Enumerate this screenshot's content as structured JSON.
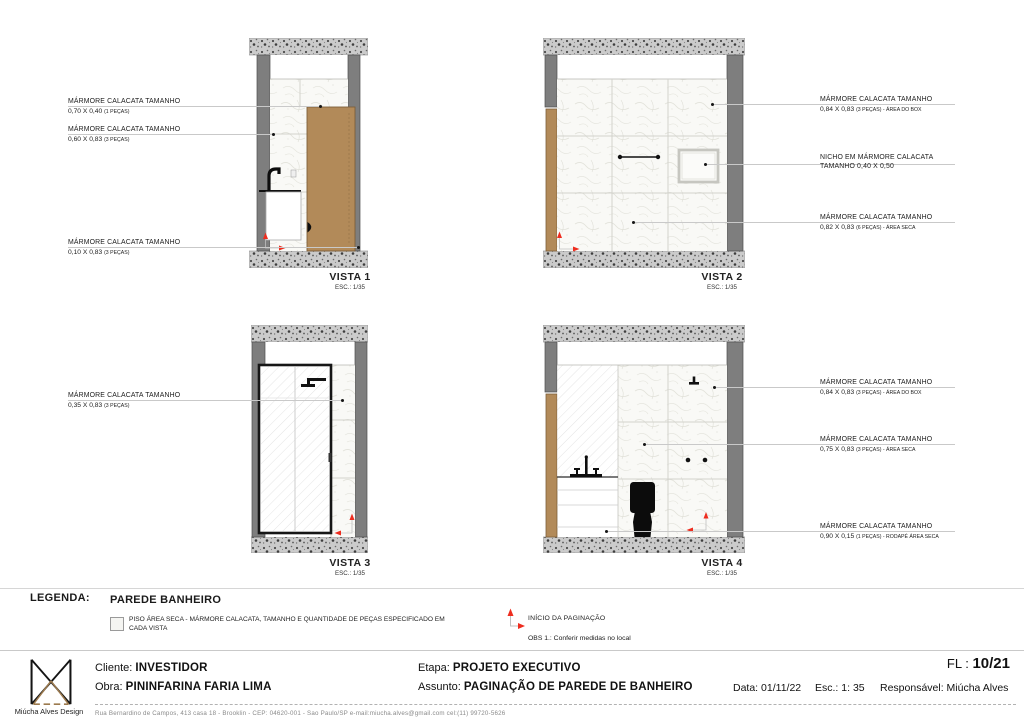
{
  "vistas": [
    {
      "label": "VISTA 1",
      "esc": "ESC.: 1/35"
    },
    {
      "label": "VISTA 2",
      "esc": "ESC.: 1/35"
    },
    {
      "label": "VISTA 3",
      "esc": "ESC.: 1/35"
    },
    {
      "label": "VISTA 4",
      "esc": "ESC.: 1/35"
    }
  ],
  "ann": {
    "v1": [
      {
        "title": "MÁRMORE CALACATA TAMANHO",
        "dim": "0,70 X 0,40",
        "note": "(1 PEÇAS)"
      },
      {
        "title": "MÁRMORE CALACATA TAMANHO",
        "dim": "0,60 X 0,83",
        "note": "(3 PEÇAS)"
      },
      {
        "title": "MÁRMORE CALACATA TAMANHO",
        "dim": "0,10 X 0,83",
        "note": "(3 PEÇAS)"
      }
    ],
    "v2": [
      {
        "title": "MÁRMORE CALACATA TAMANHO",
        "dim": "0,84 X 0,83",
        "note": "(3 PEÇAS) - ÁREA DO BOX"
      },
      {
        "title": "NICHO EM MÁRMORE CALACATA",
        "line2": "TAMANHO 0,40 X 0,50"
      },
      {
        "title": "MÁRMORE CALACATA TAMANHO",
        "dim": "0,82 X 0,83",
        "note": "(6 PEÇAS) - ÁREA SECA"
      }
    ],
    "v3": [
      {
        "title": "MÁRMORE CALACATA TAMANHO",
        "dim": "0,35 X 0,83",
        "note": "(3 PEÇAS)"
      }
    ],
    "v4": [
      {
        "title": "MÁRMORE CALACATA TAMANHO",
        "dim": "0,84 X 0,83",
        "note": "(3 PEÇAS) - ÁREA DO BOX"
      },
      {
        "title": "MÁRMORE CALACATA TAMANHO",
        "dim": "0,75 X 0,83",
        "note": "(3 PEÇAS) - ÁREA SECA"
      },
      {
        "title": "MÁRMORE CALACATA TAMANHO",
        "dim": "0,90 X 0,15",
        "note": "(1 PEÇAS) - RODAPÉ ÁREA SECA"
      }
    ]
  },
  "legend": {
    "heading": "LEGENDA:",
    "group_title": "PAREDE BANHEIRO",
    "swatch_text": "PISO ÁREA SECA - MÁRMORE CALACATA, TAMANHO E QUANTIDADE DE PEÇAS ESPECIFICADO EM CADA VISTA",
    "marker_label": "INÍCIO DA PAGINAÇÃO",
    "obs": "OBS 1.: Conferir medidas no local"
  },
  "titleblock": {
    "brand": "Miúcha Alves Design",
    "cliente_label": "Cliente:",
    "cliente": "INVESTIDOR",
    "obra_label": "Obra:",
    "obra": "PININFARINA FARIA LIMA",
    "etapa_label": "Etapa:",
    "etapa": "PROJETO EXECUTIVO",
    "assunto_label": "Assunto:",
    "assunto": "PAGINAÇÃO DE PAREDE DE BANHEIRO",
    "data_label": "Data:",
    "data": "01/11/22",
    "esc_label": "Esc.:",
    "esc": "1: 35",
    "resp_label": "Responsável:",
    "resp": "Miúcha Alves",
    "fl_label": "FL :",
    "fl": "10/21",
    "address": "Rua Bernardino de Campos,  413  casa 18  -  Brooklin  -  CEP: 04620-001  -  Sao Paulo/SP   e-mail:miucha.alves@gmail.com   cel:(11) 99720-5626"
  },
  "colors": {
    "accent_red": "#EE2D1F",
    "wood": "#B28A59",
    "wall_gray": "#7E7E7E",
    "concrete": "#CBCBCB"
  }
}
